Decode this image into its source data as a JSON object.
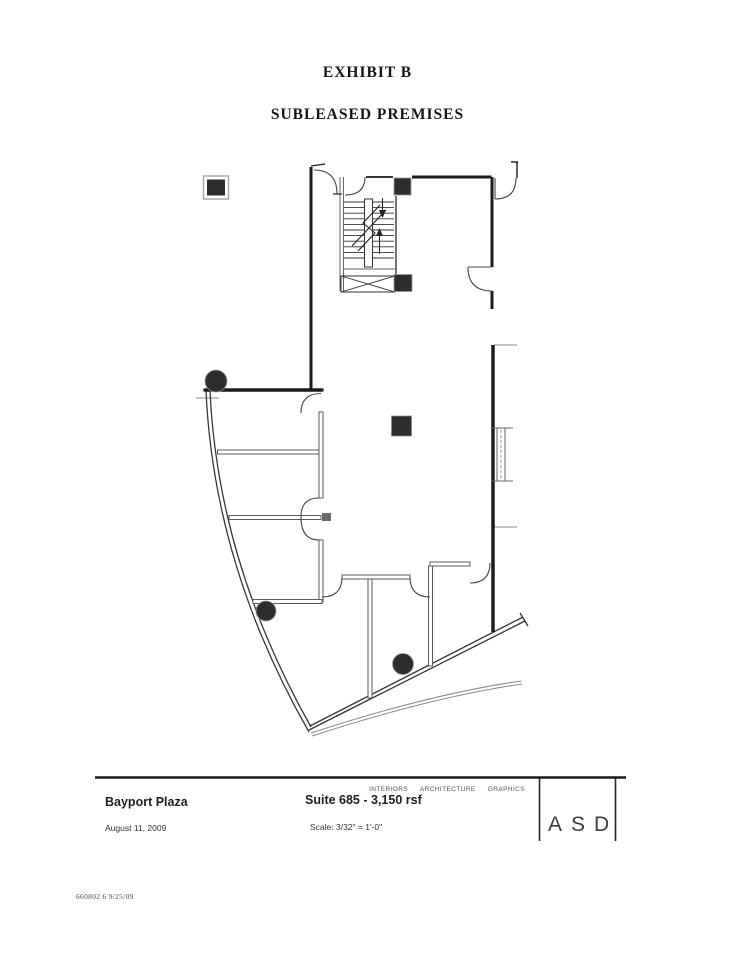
{
  "document": {
    "exhibit_title": "EXHIBIT B",
    "premises_subtitle": "SUBLEASED PREMISES",
    "stamp_number": "660802 6 9/25/09"
  },
  "title_block": {
    "project_name": "Bayport Plaza",
    "issue_date": "August 11, 2009",
    "suite_area": "Suite 685 - 3,150 rsf",
    "drawing_scale": "Scale: 3/32\" = 1'-0\"",
    "firm_services": "INTERIORS ARCHITECTURE GRAPHICS",
    "firm_name": "ASD"
  },
  "colors": {
    "paper": "#ffffff",
    "ink": "#1c1c1c",
    "thin_line": "#555555",
    "light_line": "#888888",
    "column_fill": "#2d2d2d"
  }
}
